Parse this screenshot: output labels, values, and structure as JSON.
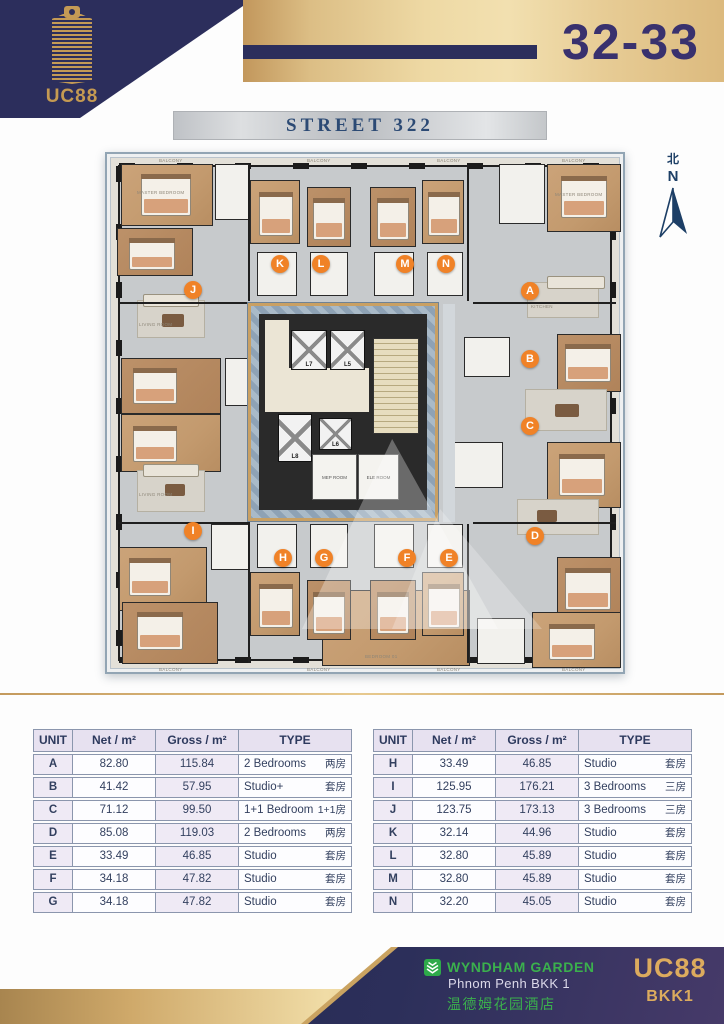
{
  "header": {
    "logo_text": "UC88",
    "floor_range": "32-33",
    "street_label": "STREET 322"
  },
  "north": {
    "cn": "北",
    "en": "N"
  },
  "plan": {
    "balcony_label": "BALCONY",
    "room_labels": {
      "master_bedroom": "MASTER BEDROOM",
      "bedroom": "BEDROOM 01",
      "living": "LIVING ROOM",
      "master_bath": "MASTER BATH",
      "kitchen": "KITCHEN"
    },
    "core": {
      "elevators": [
        "L7",
        "L5",
        "L8",
        "L6"
      ],
      "rooms": [
        "MEP ROOM",
        "ELE ROOM"
      ]
    },
    "markers": [
      {
        "letter": "A",
        "x": 423,
        "y": 137
      },
      {
        "letter": "B",
        "x": 423,
        "y": 205
      },
      {
        "letter": "C",
        "x": 423,
        "y": 272
      },
      {
        "letter": "D",
        "x": 428,
        "y": 382
      },
      {
        "letter": "E",
        "x": 342,
        "y": 404
      },
      {
        "letter": "F",
        "x": 300,
        "y": 404
      },
      {
        "letter": "G",
        "x": 217,
        "y": 404
      },
      {
        "letter": "H",
        "x": 176,
        "y": 404
      },
      {
        "letter": "I",
        "x": 86,
        "y": 377
      },
      {
        "letter": "J",
        "x": 86,
        "y": 136
      },
      {
        "letter": "K",
        "x": 173,
        "y": 110
      },
      {
        "letter": "L",
        "x": 214,
        "y": 110
      },
      {
        "letter": "M",
        "x": 298,
        "y": 110
      },
      {
        "letter": "N",
        "x": 339,
        "y": 110
      }
    ]
  },
  "tables": [
    {
      "header": {
        "unit": "UNIT",
        "net": "Net / m²",
        "gross": "Gross / m²",
        "type": "TYPE"
      },
      "rows": [
        {
          "unit": "A",
          "net": "82.80",
          "gross": "115.84",
          "type_en": "2 Bedrooms",
          "type_zh": "两房"
        },
        {
          "unit": "B",
          "net": "41.42",
          "gross": "57.95",
          "type_en": "Studio+",
          "type_zh": "套房"
        },
        {
          "unit": "C",
          "net": "71.12",
          "gross": "99.50",
          "type_en": "1+1 Bedroom",
          "type_zh": "1+1房"
        },
        {
          "unit": "D",
          "net": "85.08",
          "gross": "119.03",
          "type_en": "2 Bedrooms",
          "type_zh": "两房"
        },
        {
          "unit": "E",
          "net": "33.49",
          "gross": "46.85",
          "type_en": "Studio",
          "type_zh": "套房"
        },
        {
          "unit": "F",
          "net": "34.18",
          "gross": "47.82",
          "type_en": "Studio",
          "type_zh": "套房"
        },
        {
          "unit": "G",
          "net": "34.18",
          "gross": "47.82",
          "type_en": "Studio",
          "type_zh": "套房"
        }
      ]
    },
    {
      "header": {
        "unit": "UNIT",
        "net": "Net / m²",
        "gross": "Gross / m²",
        "type": "TYPE"
      },
      "rows": [
        {
          "unit": "H",
          "net": "33.49",
          "gross": "46.85",
          "type_en": "Studio",
          "type_zh": "套房"
        },
        {
          "unit": "I",
          "net": "125.95",
          "gross": "176.21",
          "type_en": "3 Bedrooms",
          "type_zh": "三房"
        },
        {
          "unit": "J",
          "net": "123.75",
          "gross": "173.13",
          "type_en": "3 Bedrooms",
          "type_zh": "三房"
        },
        {
          "unit": "K",
          "net": "32.14",
          "gross": "44.96",
          "type_en": "Studio",
          "type_zh": "套房"
        },
        {
          "unit": "L",
          "net": "32.80",
          "gross": "45.89",
          "type_en": "Studio",
          "type_zh": "套房"
        },
        {
          "unit": "M",
          "net": "32.80",
          "gross": "45.89",
          "type_en": "Studio",
          "type_zh": "套房"
        },
        {
          "unit": "N",
          "net": "32.20",
          "gross": "45.05",
          "type_en": "Studio",
          "type_zh": "套房"
        }
      ]
    }
  ],
  "footer": {
    "brand": "WYNDHAM GARDEN",
    "location": "Phnom Penh BKK 1",
    "brand_zh": "温德姆花园酒店",
    "project": "UC88",
    "area": "BKK1"
  },
  "colors": {
    "navy": "#2c2e5c",
    "gold": "#caa361",
    "orange": "#f08227",
    "green": "#3bb04d",
    "table_text": "#33405f",
    "lavender": "#efeaf5"
  }
}
